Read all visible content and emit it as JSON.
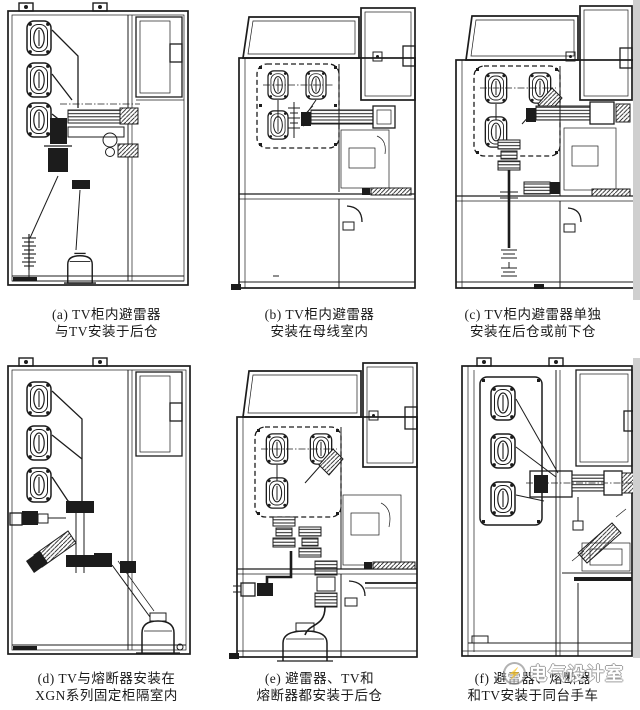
{
  "page": {
    "background": "#ffffff",
    "line_color": "#1c1c1c",
    "right_strip_color": "#cfcfcf",
    "type": "switchgear-cabinet-installation-diagrams"
  },
  "figures": [
    {
      "id": "a",
      "caption_line1": "(a) TV柜内避雷器",
      "caption_line2": "与TV安装于后仓"
    },
    {
      "id": "b",
      "caption_line1": "(b) TV柜内避雷器",
      "caption_line2": "安装在母线室内"
    },
    {
      "id": "c",
      "caption_line1": "(c) TV柜内避雷器单独",
      "caption_line2": "安装在后仓或前下仓"
    },
    {
      "id": "d",
      "caption_line1": "(d) TV与熔断器安装在",
      "caption_line2": "XGN系列固定柜隔室内"
    },
    {
      "id": "e",
      "caption_line1": "(e) 避雷器、TV和",
      "caption_line2": "熔断器都安装于后仓"
    },
    {
      "id": "f",
      "caption_line1": "(f) 避雷器、熔断器",
      "caption_line2": "和TV安装于同台手车"
    }
  ],
  "watermark": {
    "text": "电气设计室",
    "icon": "lightning-badge-icon",
    "icon_glyph": "⚡"
  }
}
